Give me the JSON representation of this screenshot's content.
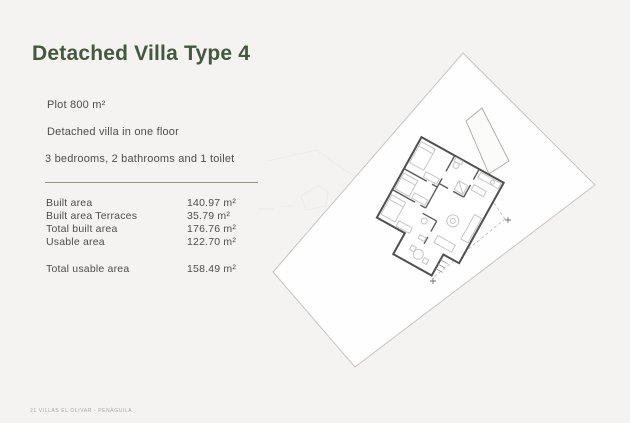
{
  "document": {
    "title": "Detached Villa Type 4",
    "footer": "21 VILLAS EL OLIVAR - PENÀGUILA"
  },
  "specs": {
    "plot": "Plot 800 m²",
    "description": "Detached villa in one floor",
    "rooms": "3 bedrooms, 2 bathrooms and 1 toilet"
  },
  "areas": {
    "rows": [
      {
        "label": "Built area",
        "value": "140.97 m²"
      },
      {
        "label": "Built area Terraces",
        "value": "35.79 m²"
      },
      {
        "label": "Total built area",
        "value": "176.76 m²"
      },
      {
        "label": "Usable area",
        "value": "122.70 m²"
      }
    ],
    "total": {
      "label": "Total usable area",
      "value": "158.49 m²"
    }
  },
  "plan": {
    "type": "site-plan-drawing",
    "elements": [
      "plot-boundary",
      "villa-floor-plan",
      "pool",
      "setback-dashed-lines",
      "survey-markers"
    ]
  },
  "colors": {
    "background": "#f4f3f1",
    "title_green": "#44583f",
    "body_text": "#4e4e4e",
    "plan_walls": "#4f4f4f",
    "plan_furniture": "#c6c6c6",
    "plot_outline": "#c7c5c1"
  }
}
